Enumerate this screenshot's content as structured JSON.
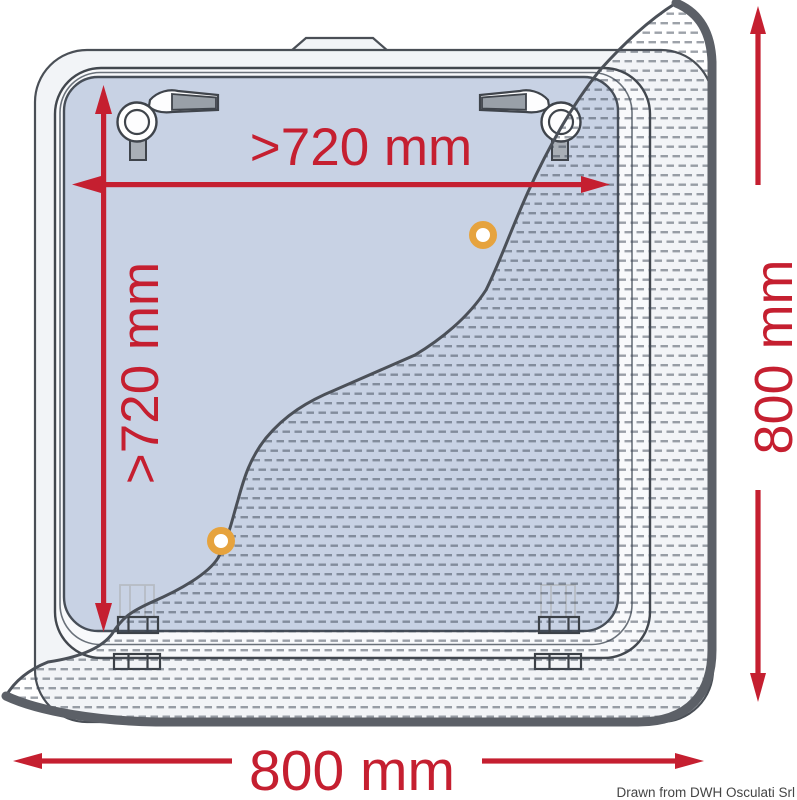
{
  "drawing": {
    "type": "hatch-installation-dimension-diagram",
    "dimensions": {
      "cutout_width_label": ">720 mm",
      "cutout_height_label": ">720 mm",
      "overall_height_label": "800 mm",
      "overall_width_label": "800 mm"
    },
    "credit": "Drawn from DWH Osculati Srl",
    "colors": {
      "dimension_red": "#c51f30",
      "glass_blue": "#c8d2e4",
      "frame_light": "#f2f4f7",
      "lid_rim": "#f8f9fb",
      "outer_edge_dark": "#5c6067",
      "outline_dark": "#42474e",
      "knob_orange": "#e6a33e",
      "mesh_dash": "#3c4654"
    },
    "parts": [
      "outer-flange",
      "lid-frame",
      "glass-pane",
      "top-tab",
      "latch-handle-left",
      "latch-handle-right",
      "hinge-left",
      "hinge-right",
      "flyscreen-mesh",
      "mesh-knob-top",
      "mesh-knob-bottom"
    ]
  }
}
